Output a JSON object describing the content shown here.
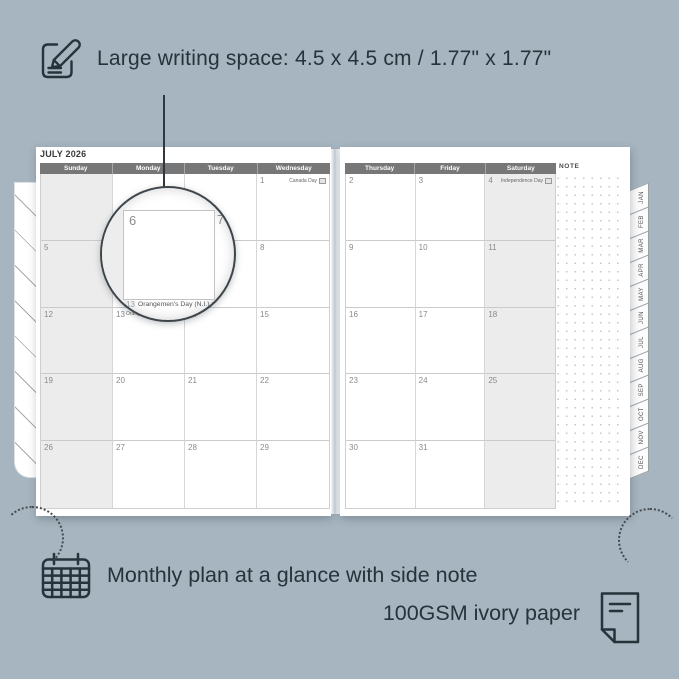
{
  "annotations": {
    "top_text": "Large writing space: 4.5 x 4.5 cm / 1.77\" x 1.77\"",
    "bottom_text_1": "Monthly plan at a glance with side note",
    "bottom_text_2": "100GSM ivory paper"
  },
  "calendar": {
    "title": "JULY 2026",
    "note_label": "NOTE",
    "left_day_headers": [
      "Sunday",
      "Monday",
      "Tuesday",
      "Wednesday"
    ],
    "right_day_headers": [
      "Thursday",
      "Friday",
      "Saturday"
    ],
    "left_cells": [
      {
        "date": ""
      },
      {
        "date": ""
      },
      {
        "date": ""
      },
      {
        "date": "1",
        "holiday": "Canada Day",
        "flag": "canada-flag-icon",
        "holiday_align": "right"
      },
      {
        "date": "5"
      },
      {
        "date": "6"
      },
      {
        "date": "7"
      },
      {
        "date": "8"
      },
      {
        "date": "12"
      },
      {
        "date": "13",
        "holiday": "Orangemen's Day (N.I.)",
        "flag": "ni-flag-icon",
        "holiday_align": "left"
      },
      {
        "date": "14"
      },
      {
        "date": "15"
      },
      {
        "date": "19"
      },
      {
        "date": "20"
      },
      {
        "date": "21"
      },
      {
        "date": "22"
      },
      {
        "date": "26"
      },
      {
        "date": "27"
      },
      {
        "date": "28"
      },
      {
        "date": "29"
      }
    ],
    "right_cells": [
      {
        "date": "2"
      },
      {
        "date": "3"
      },
      {
        "date": "4",
        "holiday": "Independence Day",
        "flag": "us-flag-icon",
        "holiday_align": "right"
      },
      {
        "date": "9"
      },
      {
        "date": "10"
      },
      {
        "date": "11"
      },
      {
        "date": "16"
      },
      {
        "date": "17"
      },
      {
        "date": "18"
      },
      {
        "date": "23"
      },
      {
        "date": "24"
      },
      {
        "date": "25"
      },
      {
        "date": "30"
      },
      {
        "date": "31"
      },
      {
        "date": ""
      }
    ],
    "month_tabs": [
      "JAN",
      "FEB",
      "MAR",
      "APR",
      "MAY",
      "JUN",
      "JUL",
      "AUG",
      "SEP",
      "OCT",
      "NOV",
      "DEC"
    ]
  },
  "magnifier": {
    "left_date": "6",
    "right_date": "7",
    "caption_date": "13",
    "caption": "Orangemen's Day (N.I.)"
  },
  "icons": {
    "top": "pencil-note-icon",
    "bottom_left": "calendar-grid-icon",
    "bottom_right": "paper-note-icon",
    "holiday_flags": [
      "canada-flag-icon",
      "us-flag-icon",
      "ni-flag-icon"
    ]
  },
  "colors": {
    "background": "#a6b5bf",
    "ink": "#25333b",
    "header_bar": "#777777",
    "shaded_column": "#ececec",
    "grid_line": "#cdcdcd",
    "page": "#ffffff"
  }
}
